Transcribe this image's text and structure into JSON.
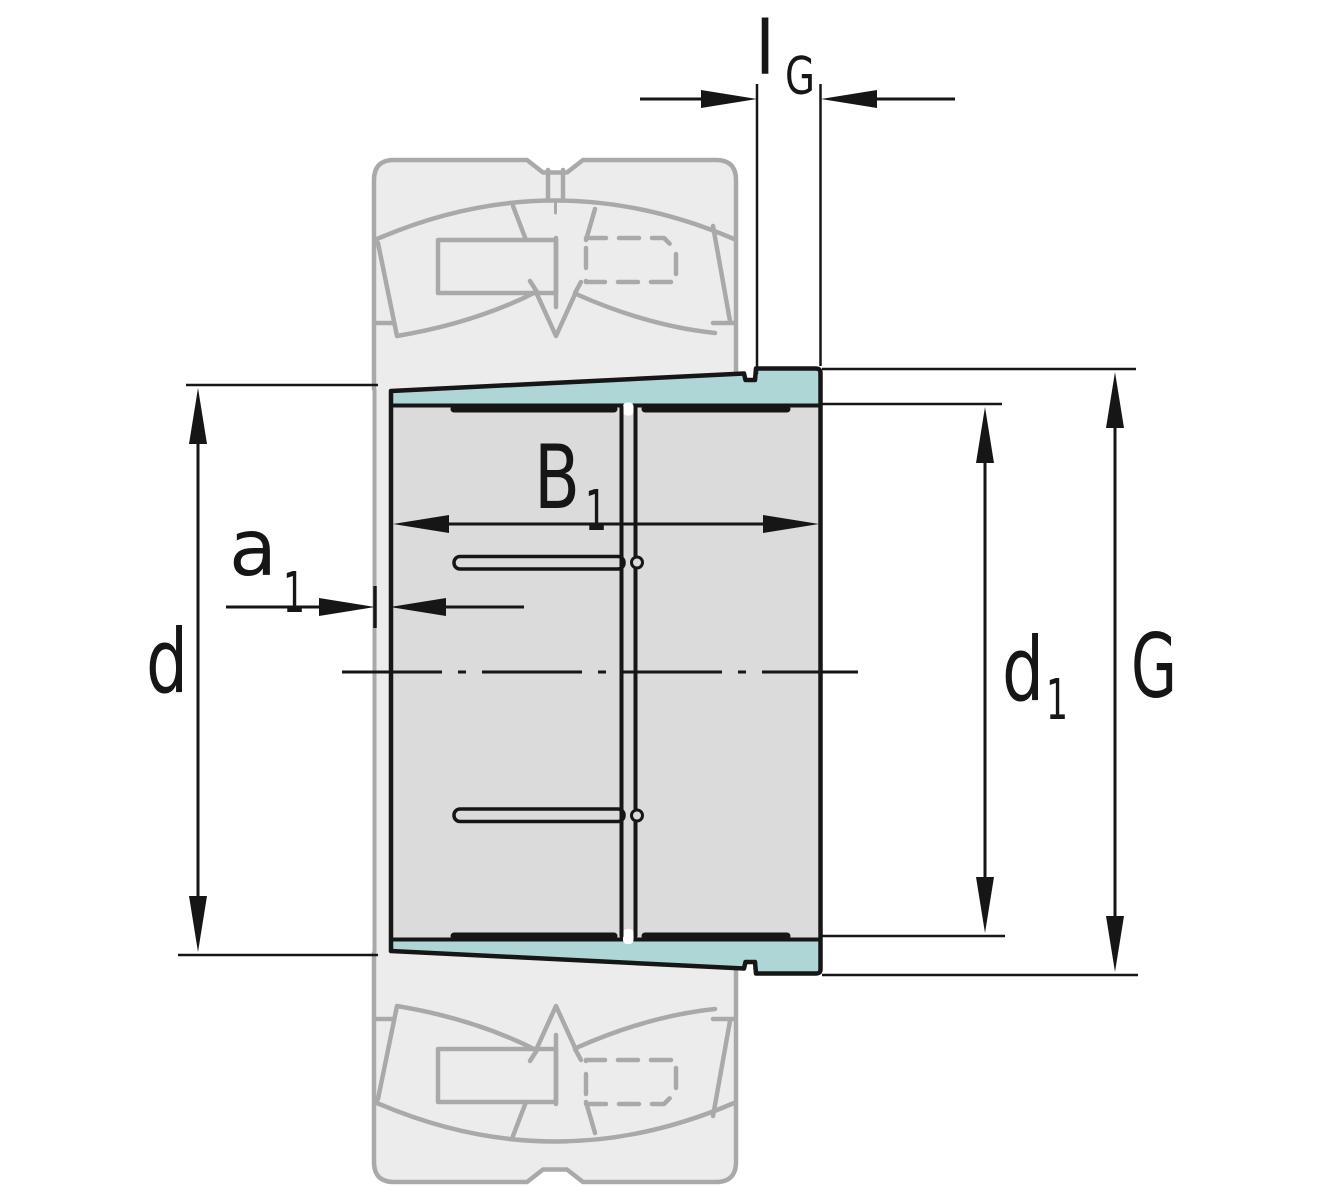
{
  "drawing": {
    "kind": "bearing adapter sleeve dimension drawing",
    "colors": {
      "background": "#ffffff",
      "outline": "#161616",
      "sleeve_fill": "#dbdbdb",
      "taper_highlight": "#afd6d6",
      "ghost_fill": "#ececec",
      "ghost_line": "#a9a9a9"
    },
    "labels": {
      "lG": {
        "main": "l",
        "sub": "G"
      },
      "B1": {
        "main": "B",
        "sub": "1"
      },
      "a1": {
        "main": "a",
        "sub": "1"
      },
      "d": {
        "main": "d"
      },
      "d1": {
        "main": "d",
        "sub": "1"
      },
      "G": {
        "main": "G"
      }
    }
  }
}
